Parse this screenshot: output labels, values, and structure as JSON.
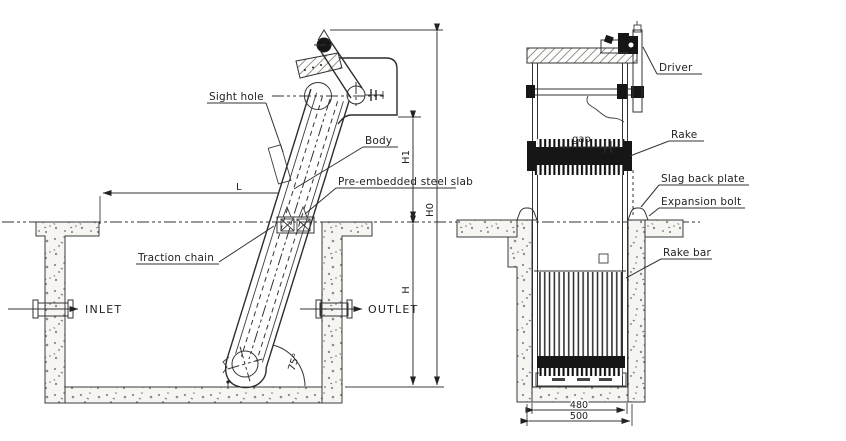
{
  "figure": {
    "type": "engineering-drawing",
    "subject": "mechanical bar screen installation, side section and front view"
  },
  "colors": {
    "background": "#ffffff",
    "line": "#333333",
    "dark_fill": "#161616",
    "concrete_speck": "#8c8c8c"
  },
  "side_view": {
    "callouts": {
      "sight_hole": "Sight hole",
      "body": "Body",
      "pre_embedded_steel_slab": "Pre-embedded steel slab",
      "traction_chain": "Traction chain"
    },
    "flow": {
      "inlet": "INLET",
      "outlet": "OUTLET"
    },
    "dimensions": {
      "length": "L",
      "h1": "H1",
      "h0": "H0",
      "h": "H",
      "incline_angle": "75°"
    }
  },
  "front_view": {
    "callouts": {
      "driver": "Driver",
      "rake": "Rake",
      "slag_back_plate": "Slag back plate",
      "expansion_bolt": "Expansion bolt",
      "rake_bar": "Rake bar"
    },
    "dimensions": {
      "gap": "gap",
      "inner_width": "480",
      "outer_width": "500"
    }
  }
}
